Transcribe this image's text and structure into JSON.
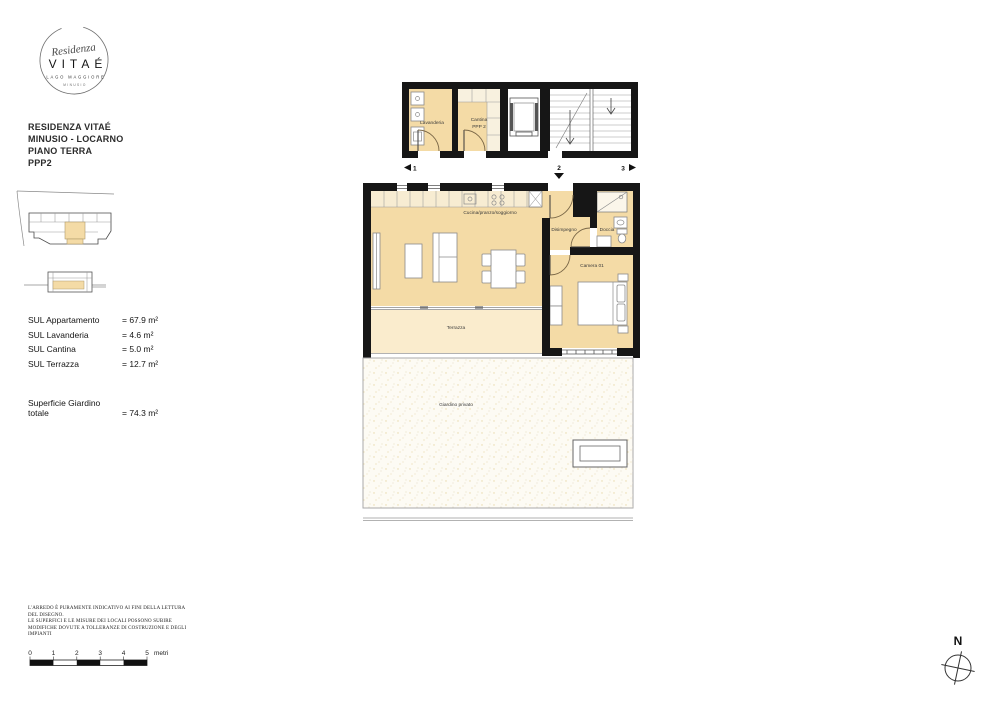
{
  "logo": {
    "script": "Residenza",
    "brand": "VITAÉ",
    "subtitle": "LAGO MAGGIORE",
    "location": "MINUSIO"
  },
  "project": {
    "line1": "RESIDENZA VITAÉ",
    "line2": "MINUSIO - LOCARNO",
    "line3": "PIANO TERRA",
    "line4": "PPP2"
  },
  "areas": {
    "rows": [
      {
        "label": "SUL Appartamento",
        "value": "= 67.9 m²"
      },
      {
        "label": "SUL Lavanderia",
        "value": "= 4.6 m²"
      },
      {
        "label": "SUL Cantina",
        "value": "= 5.0 m²"
      },
      {
        "label": "SUL Terrazza",
        "value": "= 12.7 m²"
      }
    ],
    "garden_label_line1": "Superficie Giardino",
    "garden_label_line2": "totale",
    "garden_value": "= 74.3 m²"
  },
  "plan": {
    "rooms": {
      "lavanderia": "Lavanderia",
      "cantina_line1": "Cantina",
      "cantina_line2": "PPP 2",
      "cucina": "Cucina/pranzo/soggiorno",
      "disimpegno": "Disimpegno",
      "doccia": "Doccia",
      "camera": "Camera 01",
      "terrazza": "Terrazza",
      "giardino": "Giardino privato"
    },
    "markers": {
      "m1": "1",
      "m2": "2",
      "m3": "3"
    },
    "colors": {
      "room_fill": "#f4dba6",
      "terrace_fill": "#faeccd",
      "garden_fill": "#fdfbf4",
      "kitchen_fill": "#f7ecd2",
      "shelf_fill": "#f8f1df",
      "wall": "#161616"
    }
  },
  "disclaimer": {
    "lines": [
      "L'ARREDO È PURAMENTE INDICATIVO AI FINI DELLA LETTURA",
      "DEL DISEGNO.",
      "LE SUPERFICI E LE MISURE DEI LOCALI POSSONO SUBIRE",
      "MODIFICHE DOVUTE A TOLLERANZE DI COSTRUZIONE E DEGLI",
      "IMPIANTI"
    ]
  },
  "scalebar": {
    "ticks": [
      "0",
      "1",
      "2",
      "3",
      "4",
      "5"
    ],
    "unit": "metri"
  },
  "compass": {
    "north": "N"
  }
}
